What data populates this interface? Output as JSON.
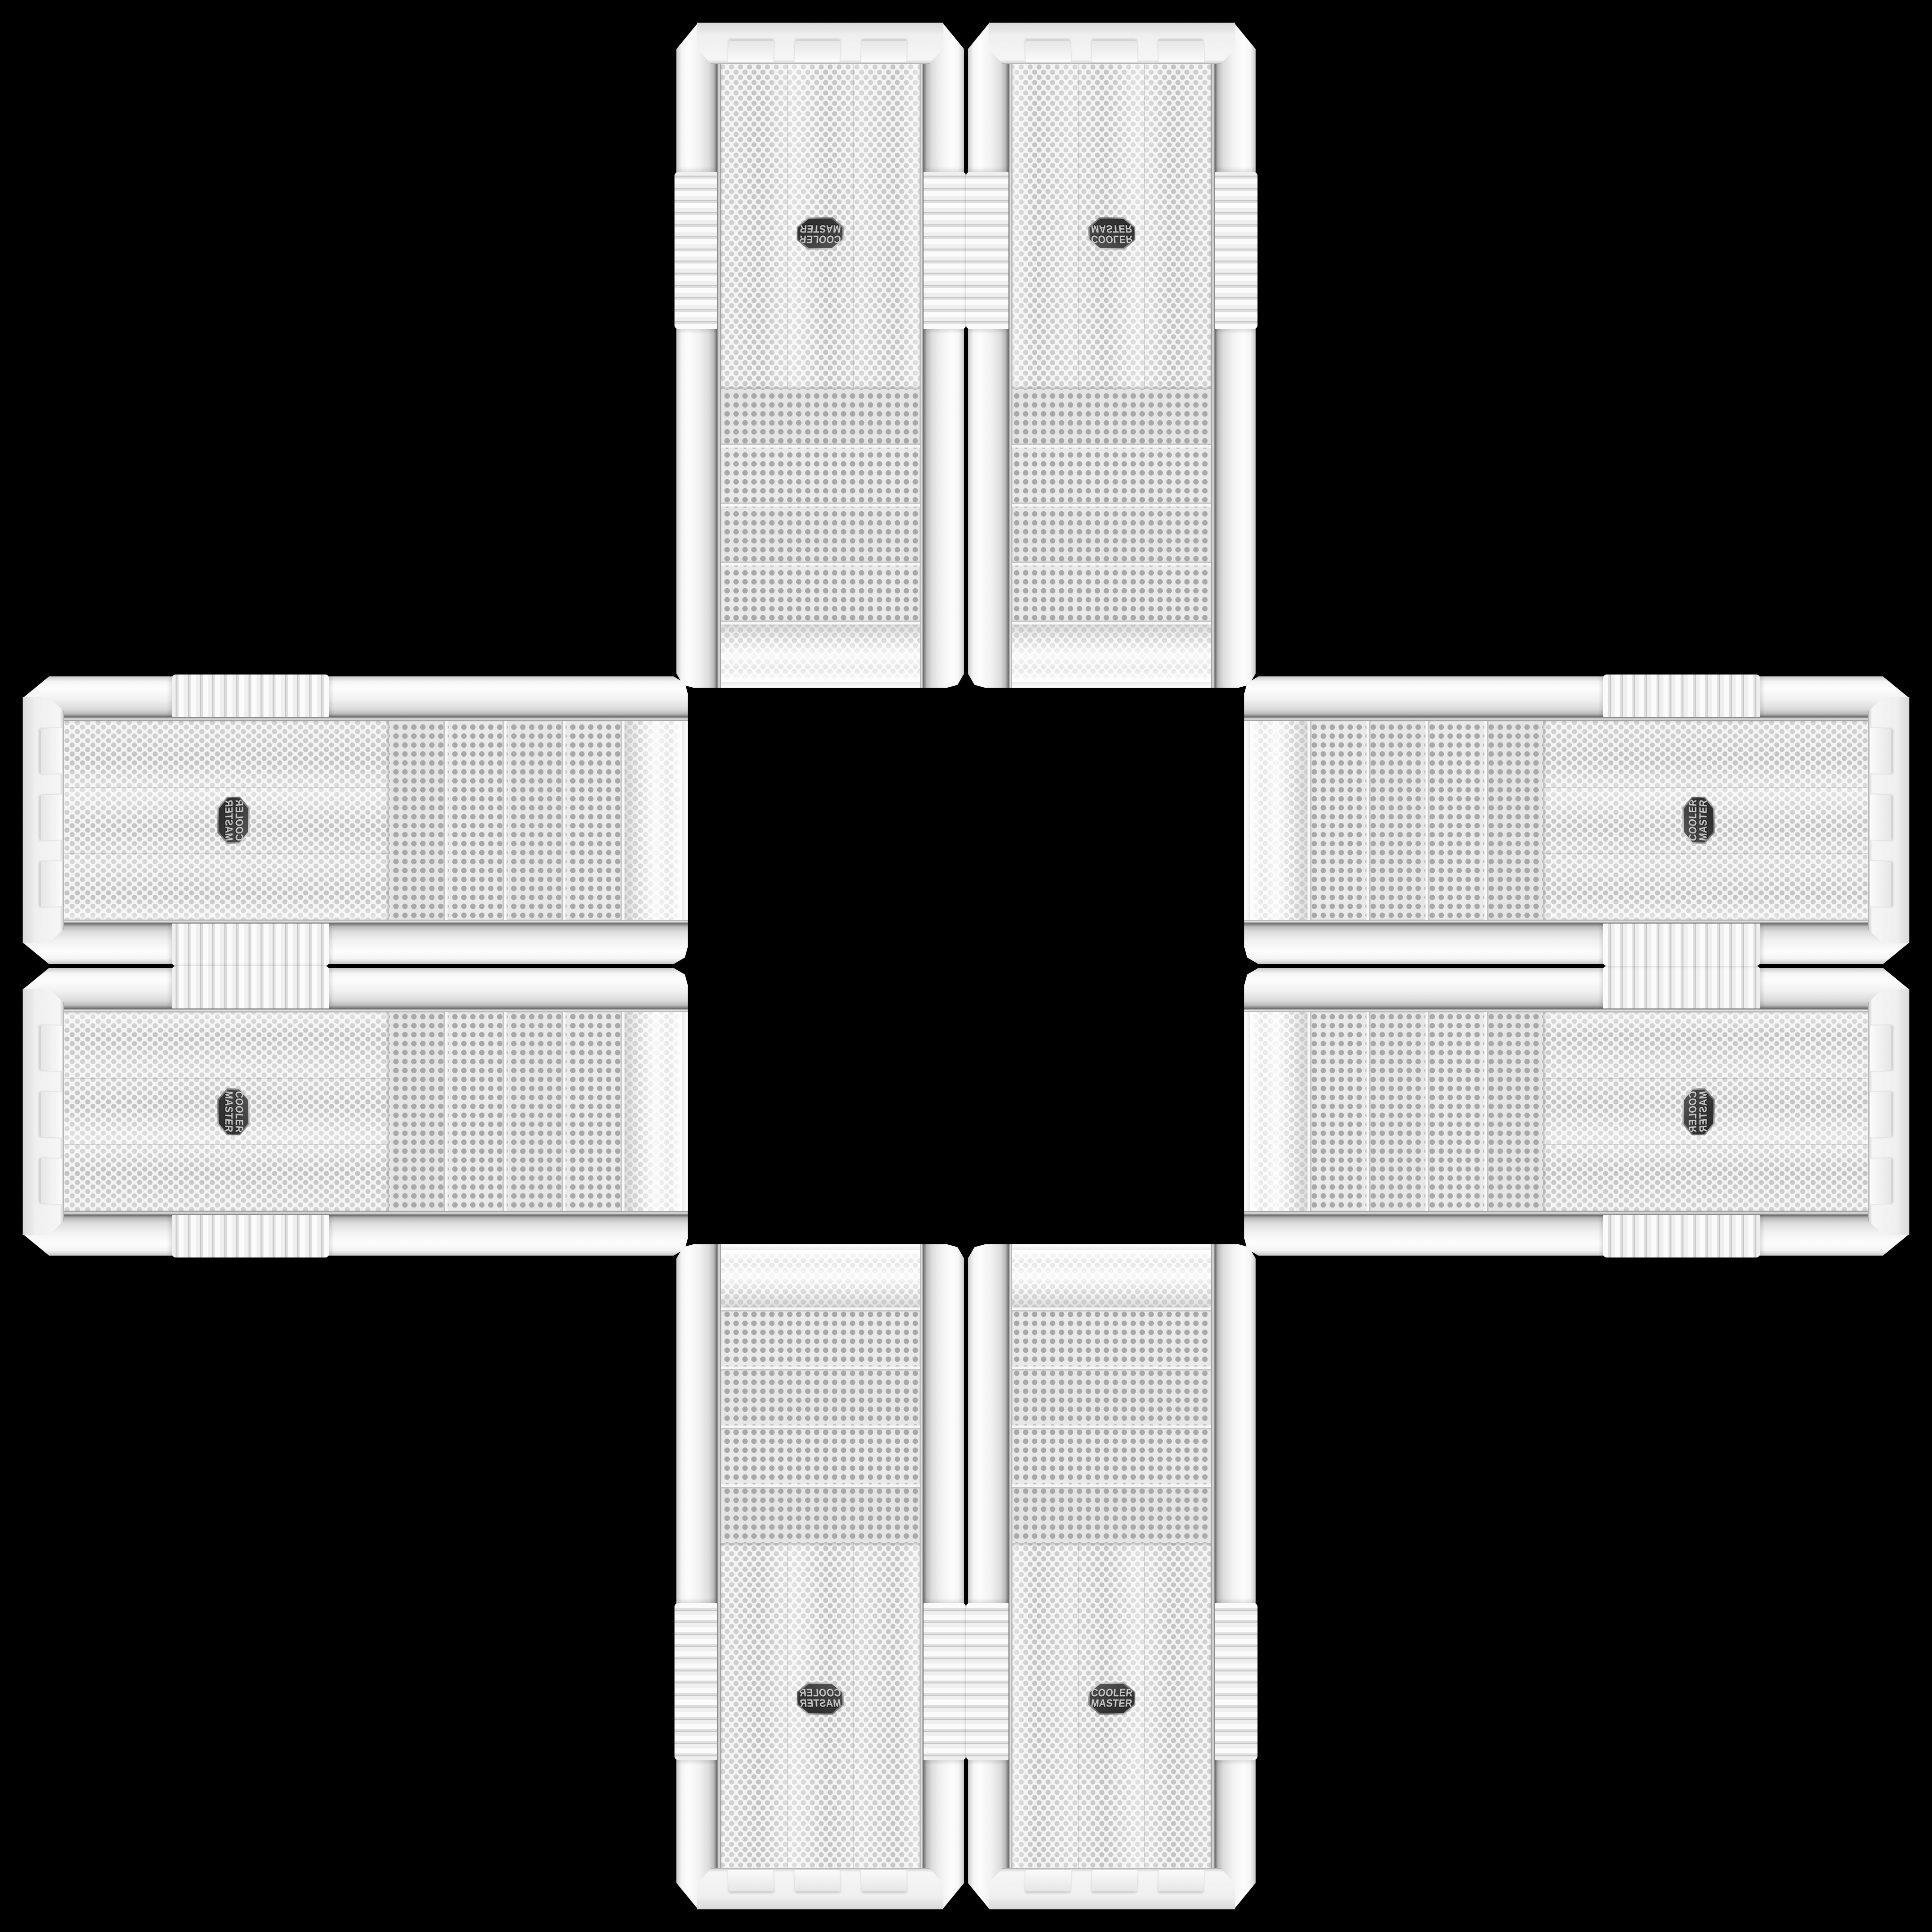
{
  "brand": {
    "line1": "COOLER",
    "line2": "MASTER"
  },
  "scene": {
    "background_color": "#000000",
    "arrangement": "plus-cross",
    "case_count": 8,
    "drive_bay_covers_per_case": 4,
    "case_body_color": "#f2f2f2",
    "mesh_dot_color": "#c3c3c3",
    "bay_mesh_dot_color": "#a9a9a9",
    "badge_face_color": "#363636",
    "badge_text_color": "#c7c7c7",
    "chrome_trim_color": "#989898"
  }
}
